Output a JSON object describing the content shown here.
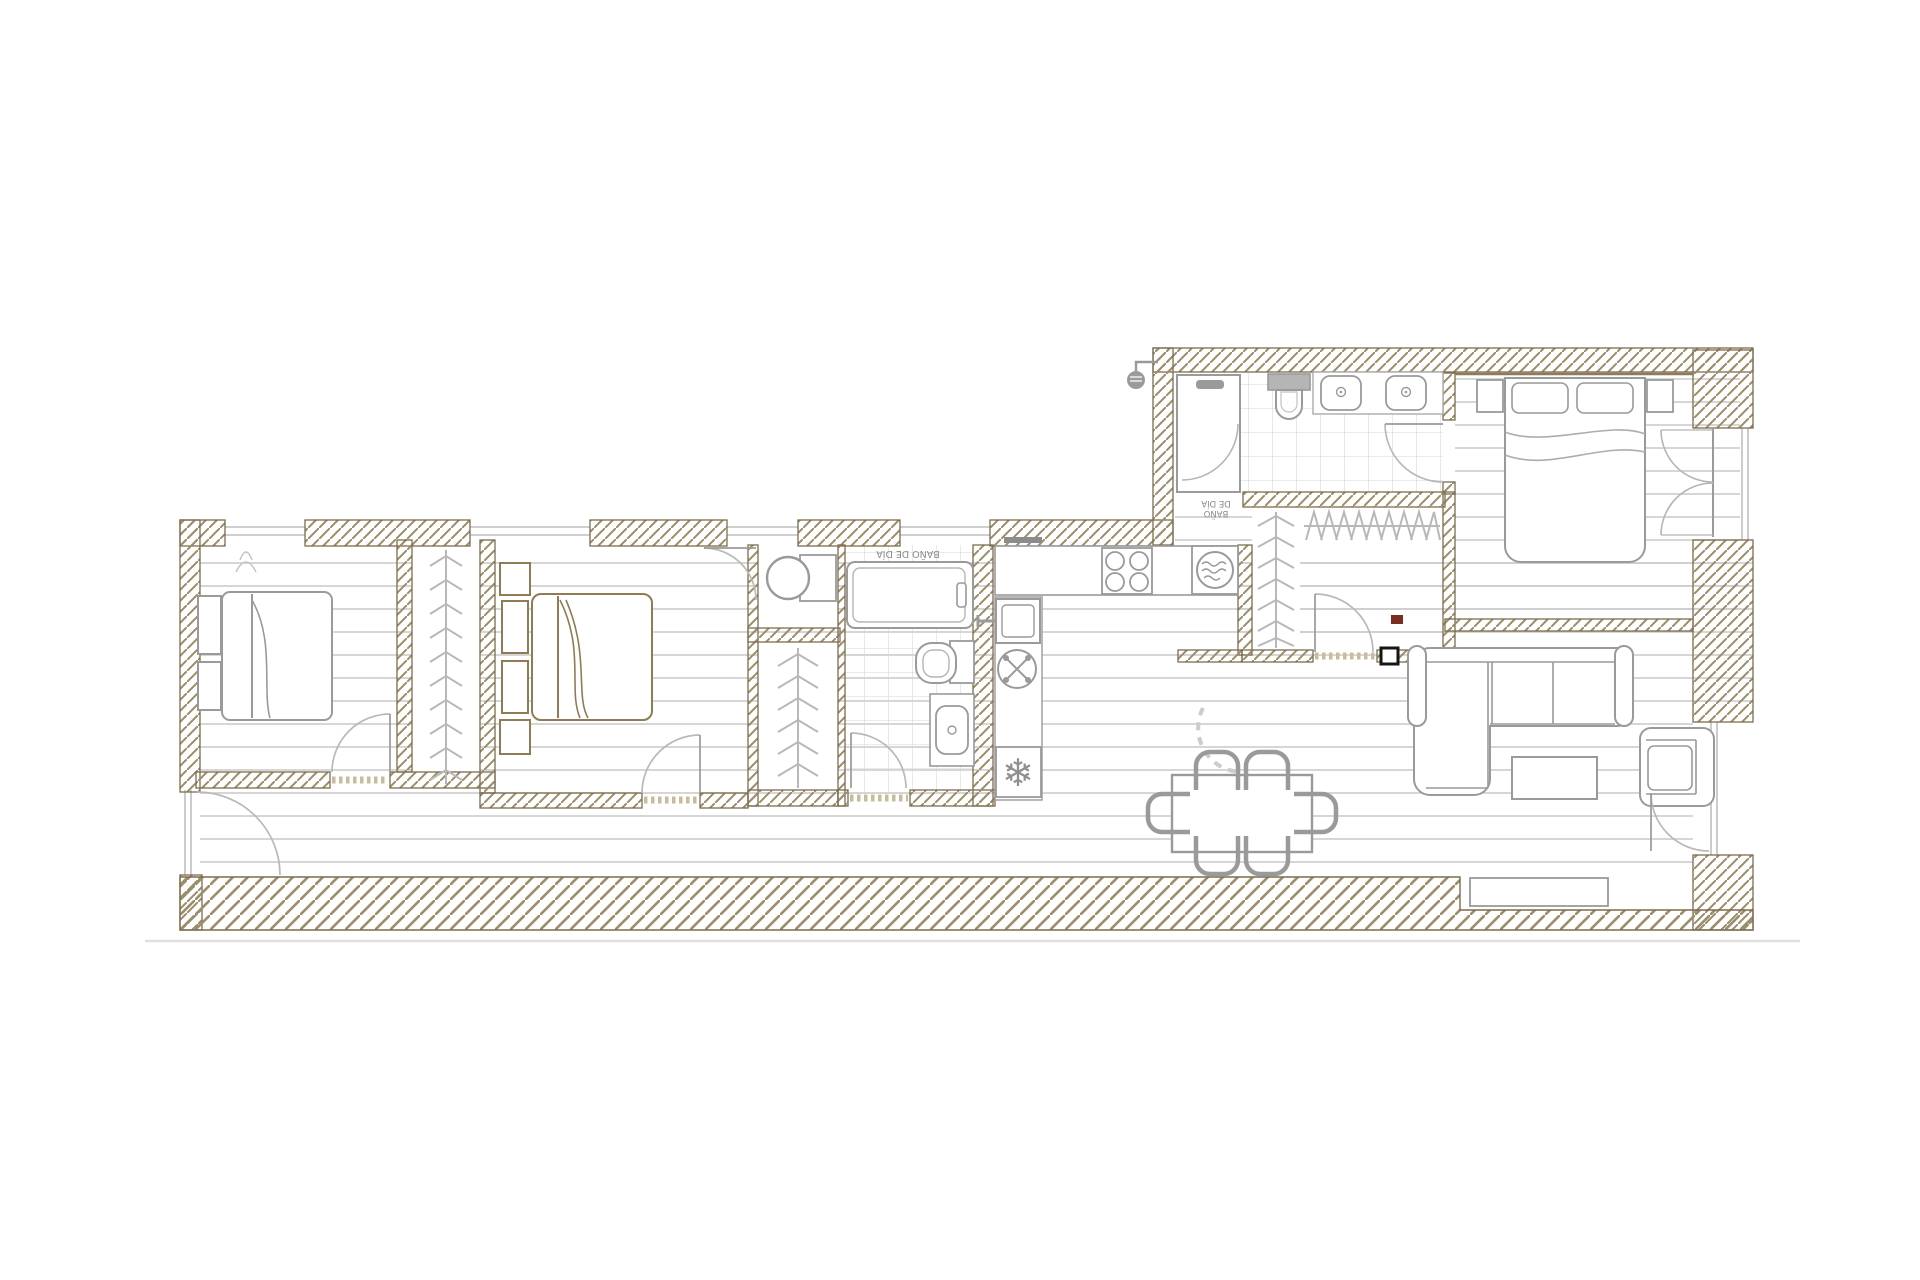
{
  "document": {
    "type": "apartment-floor-plan",
    "background": "#ffffff"
  },
  "colors": {
    "wall_edge": "#7c6c4e",
    "wall_hatch": "#9b8c6a",
    "floor_line": "#c9c9c9",
    "tile_line": "#d4d4d4",
    "fixture_gray": "#9a9a9a",
    "fixture_light": "#b8b8b8",
    "bed_brown": "#8f7c55",
    "accent_red": "#7a2e1f",
    "accent_black": "#151515",
    "threshold": "#c8bc9c"
  },
  "labels": {
    "day_bath": "BAÑO DE DÍA",
    "night_bath_line1": "BAÑO",
    "night_bath_line2": "DE DÍA"
  },
  "icons": {
    "fridge_snowflake": "❄"
  }
}
